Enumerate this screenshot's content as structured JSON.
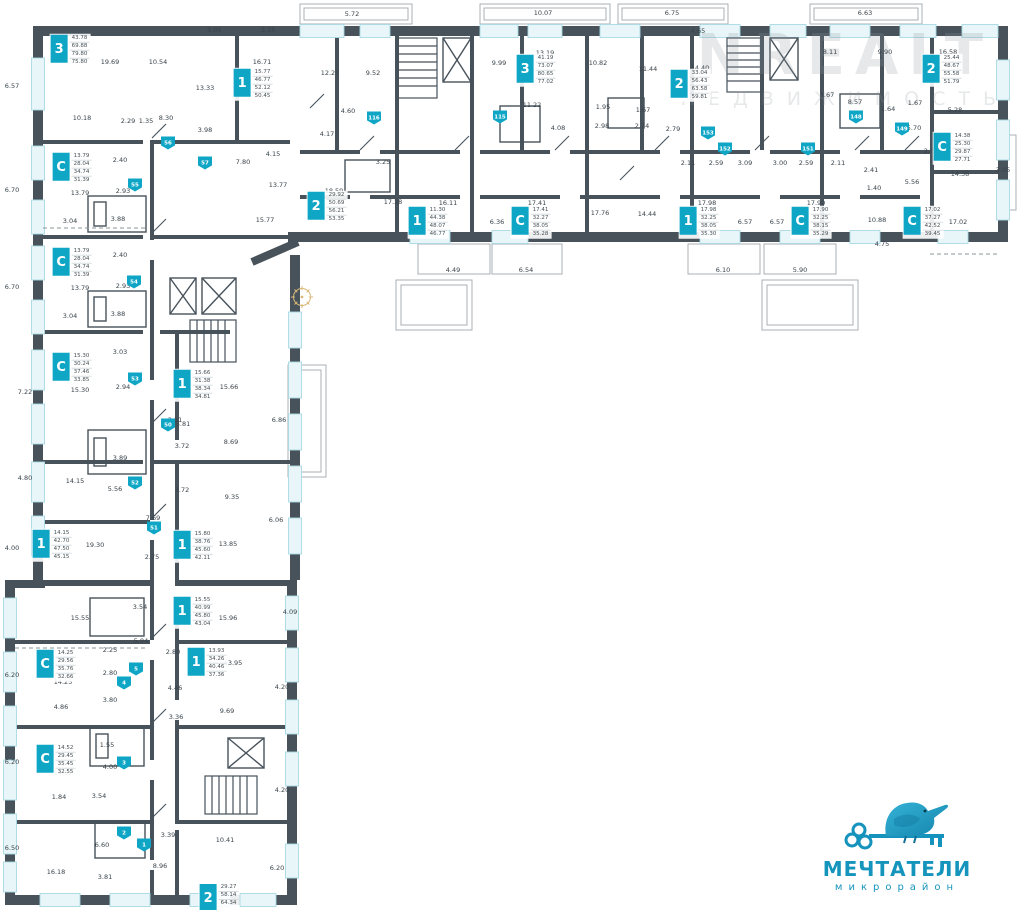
{
  "colors": {
    "accent": "#0FA6C6",
    "wall": "#47525B",
    "window": "#E8F6F9",
    "dim_text": "#39434A",
    "logo": "#1695BC"
  },
  "watermark": {
    "line1": "NREALT",
    "line2": "НЕДВИЖИМОСТЬ"
  },
  "logo": {
    "name": "МЕЧТАТЕЛИ",
    "subtitle": "микрорайон"
  },
  "plan": {
    "units": [
      {
        "type": "3",
        "x": 70,
        "y": 50,
        "areas": [
          "43.78",
          "69.88",
          "79.80",
          "75.80"
        ]
      },
      {
        "type": "1",
        "x": 253,
        "y": 84,
        "areas": [
          "15.77",
          "46.77",
          "52.12",
          "50.45"
        ]
      },
      {
        "type": "2",
        "x": 327,
        "y": 207,
        "areas": [
          "29.92",
          "50.69",
          "56.21",
          "53.35"
        ]
      },
      {
        "type": "3",
        "x": 536,
        "y": 70,
        "areas": [
          "41.19",
          "73.07",
          "80.65",
          "77.02"
        ]
      },
      {
        "type": "1",
        "x": 428,
        "y": 222,
        "areas": [
          "11.30",
          "44.38",
          "48.07",
          "46.77"
        ]
      },
      {
        "type": "C",
        "x": 531,
        "y": 222,
        "areas": [
          "17.41",
          "32.27",
          "38.05",
          "35.28"
        ]
      },
      {
        "type": "2",
        "x": 690,
        "y": 85,
        "areas": [
          "33.04",
          "56.43",
          "63.58",
          "59.81"
        ]
      },
      {
        "type": "1",
        "x": 699,
        "y": 222,
        "areas": [
          "17.98",
          "32.25",
          "38.05",
          "35.30"
        ]
      },
      {
        "type": "C",
        "x": 811,
        "y": 222,
        "areas": [
          "17.90",
          "32.25",
          "38.15",
          "35.29"
        ]
      },
      {
        "type": "2",
        "x": 942,
        "y": 70,
        "areas": [
          "25.44",
          "48.67",
          "55.58",
          "51.79"
        ]
      },
      {
        "type": "C",
        "x": 953,
        "y": 148,
        "areas": [
          "14.38",
          "25.30",
          "29.87",
          "27.71"
        ]
      },
      {
        "type": "C",
        "x": 923,
        "y": 222,
        "areas": [
          "17.02",
          "37.27",
          "42.52",
          "39.45"
        ]
      },
      {
        "type": "C",
        "x": 72,
        "y": 168,
        "areas": [
          "13.79",
          "28.04",
          "34.74",
          "31.39"
        ]
      },
      {
        "type": "C",
        "x": 72,
        "y": 263,
        "areas": [
          "13.79",
          "28.04",
          "34.74",
          "31.39"
        ]
      },
      {
        "type": "C",
        "x": 72,
        "y": 368,
        "areas": [
          "15.30",
          "30.24",
          "37.46",
          "33.85"
        ]
      },
      {
        "type": "1",
        "x": 193,
        "y": 385,
        "areas": [
          "15.66",
          "31.38",
          "38.34",
          "34.81"
        ]
      },
      {
        "type": "1",
        "x": 52,
        "y": 545,
        "areas": [
          "14.15",
          "42.70",
          "47.50",
          "45.15"
        ]
      },
      {
        "type": "1",
        "x": 193,
        "y": 546,
        "areas": [
          "15.80",
          "38.76",
          "45.60",
          "42.11"
        ]
      },
      {
        "type": "1",
        "x": 193,
        "y": 612,
        "areas": [
          "15.55",
          "40.99",
          "45.80",
          "43.04"
        ]
      },
      {
        "type": "C",
        "x": 56,
        "y": 665,
        "areas": [
          "14.25",
          "29.56",
          "35.76",
          "32.66"
        ]
      },
      {
        "type": "1",
        "x": 207,
        "y": 663,
        "areas": [
          "13.93",
          "34.26",
          "40.46",
          "37.36"
        ]
      },
      {
        "type": "C",
        "x": 56,
        "y": 760,
        "areas": [
          "14.52",
          "29.45",
          "35.45",
          "32.55"
        ]
      },
      {
        "type": "2",
        "x": 219,
        "y": 898,
        "areas": [
          "29.27",
          "58.14",
          "64.34"
        ]
      }
    ],
    "doors": [
      {
        "x": 168,
        "y": 143,
        "n": "56"
      },
      {
        "x": 205,
        "y": 163,
        "n": "57"
      },
      {
        "x": 135,
        "y": 185,
        "n": "55"
      },
      {
        "x": 134,
        "y": 282,
        "n": "54"
      },
      {
        "x": 135,
        "y": 379,
        "n": "53"
      },
      {
        "x": 135,
        "y": 483,
        "n": "52"
      },
      {
        "x": 154,
        "y": 528,
        "n": "51"
      },
      {
        "x": 168,
        "y": 425,
        "n": "50"
      },
      {
        "x": 136,
        "y": 669,
        "n": "5"
      },
      {
        "x": 124,
        "y": 683,
        "n": "4"
      },
      {
        "x": 124,
        "y": 763,
        "n": "3"
      },
      {
        "x": 124,
        "y": 833,
        "n": "2"
      },
      {
        "x": 144,
        "y": 845,
        "n": "1"
      },
      {
        "x": 500,
        "y": 117,
        "n": "115"
      },
      {
        "x": 374,
        "y": 118,
        "n": "116"
      },
      {
        "x": 856,
        "y": 117,
        "n": "148"
      },
      {
        "x": 902,
        "y": 129,
        "n": "149"
      },
      {
        "x": 808,
        "y": 149,
        "n": "151"
      },
      {
        "x": 725,
        "y": 149,
        "n": "152"
      },
      {
        "x": 708,
        "y": 133,
        "n": "153"
      }
    ],
    "dims": [
      {
        "x": 352,
        "y": 14,
        "t": "5.72"
      },
      {
        "x": 543,
        "y": 13,
        "t": "10.07"
      },
      {
        "x": 672,
        "y": 13,
        "t": "6.75"
      },
      {
        "x": 865,
        "y": 13,
        "t": "6.63"
      },
      {
        "x": 698,
        "y": 31,
        "t": "4.65"
      },
      {
        "x": 110,
        "y": 62,
        "t": "19.69"
      },
      {
        "x": 158,
        "y": 62,
        "t": "10.54"
      },
      {
        "x": 205,
        "y": 88,
        "t": "13.33"
      },
      {
        "x": 82,
        "y": 118,
        "t": "10.18"
      },
      {
        "x": 128,
        "y": 121,
        "t": "2.29"
      },
      {
        "x": 146,
        "y": 121,
        "t": "1.35"
      },
      {
        "x": 166,
        "y": 118,
        "t": "8.30"
      },
      {
        "x": 205,
        "y": 130,
        "t": "3.98"
      },
      {
        "x": 214,
        "y": 30,
        "t": "3.05"
      },
      {
        "x": 268,
        "y": 30,
        "t": "3.35"
      },
      {
        "x": 262,
        "y": 62,
        "t": "16.71"
      },
      {
        "x": 12,
        "y": 86,
        "t": "6.57"
      },
      {
        "x": 12,
        "y": 190,
        "t": "6.70"
      },
      {
        "x": 12,
        "y": 287,
        "t": "6.70"
      },
      {
        "x": 25,
        "y": 392,
        "t": "7.22"
      },
      {
        "x": 25,
        "y": 478,
        "t": "4.80"
      },
      {
        "x": 12,
        "y": 548,
        "t": "4.00"
      },
      {
        "x": 12,
        "y": 675,
        "t": "6.20"
      },
      {
        "x": 12,
        "y": 762,
        "t": "6.20"
      },
      {
        "x": 12,
        "y": 848,
        "t": "6.50"
      },
      {
        "x": 120,
        "y": 160,
        "t": "2.40"
      },
      {
        "x": 80,
        "y": 193,
        "t": "13.79"
      },
      {
        "x": 123,
        "y": 191,
        "t": "2.93"
      },
      {
        "x": 118,
        "y": 219,
        "t": "3.88"
      },
      {
        "x": 70,
        "y": 221,
        "t": "3.04"
      },
      {
        "x": 120,
        "y": 255,
        "t": "2.40"
      },
      {
        "x": 80,
        "y": 288,
        "t": "13.79"
      },
      {
        "x": 123,
        "y": 286,
        "t": "2.93"
      },
      {
        "x": 118,
        "y": 314,
        "t": "3.88"
      },
      {
        "x": 70,
        "y": 316,
        "t": "3.04"
      },
      {
        "x": 120,
        "y": 352,
        "t": "3.03"
      },
      {
        "x": 80,
        "y": 390,
        "t": "15.30"
      },
      {
        "x": 123,
        "y": 387,
        "t": "2.94"
      },
      {
        "x": 120,
        "y": 458,
        "t": "3.89"
      },
      {
        "x": 75,
        "y": 481,
        "t": "14.15"
      },
      {
        "x": 115,
        "y": 489,
        "t": "5.56"
      },
      {
        "x": 183,
        "y": 424,
        "t": "5.81"
      },
      {
        "x": 229,
        "y": 387,
        "t": "15.66"
      },
      {
        "x": 175,
        "y": 420,
        "t": "3.31"
      },
      {
        "x": 231,
        "y": 442,
        "t": "8.69"
      },
      {
        "x": 182,
        "y": 446,
        "t": "3.72"
      },
      {
        "x": 182,
        "y": 490,
        "t": "3.72"
      },
      {
        "x": 232,
        "y": 497,
        "t": "9.35"
      },
      {
        "x": 153,
        "y": 518,
        "t": "7.69"
      },
      {
        "x": 279,
        "y": 420,
        "t": "6.86"
      },
      {
        "x": 276,
        "y": 520,
        "t": "6.06"
      },
      {
        "x": 95,
        "y": 545,
        "t": "19.30"
      },
      {
        "x": 152,
        "y": 557,
        "t": "2.75"
      },
      {
        "x": 228,
        "y": 544,
        "t": "13.85"
      },
      {
        "x": 80,
        "y": 618,
        "t": "15.55"
      },
      {
        "x": 140,
        "y": 607,
        "t": "3.54"
      },
      {
        "x": 141,
        "y": 641,
        "t": "5.94"
      },
      {
        "x": 228,
        "y": 618,
        "t": "15.96"
      },
      {
        "x": 290,
        "y": 612,
        "t": "4.09"
      },
      {
        "x": 110,
        "y": 650,
        "t": "2.25"
      },
      {
        "x": 110,
        "y": 673,
        "t": "2.80"
      },
      {
        "x": 63,
        "y": 682,
        "t": "14.25"
      },
      {
        "x": 61,
        "y": 707,
        "t": "4.86"
      },
      {
        "x": 110,
        "y": 700,
        "t": "3.80"
      },
      {
        "x": 173,
        "y": 652,
        "t": "2.80"
      },
      {
        "x": 233,
        "y": 663,
        "t": "13.95"
      },
      {
        "x": 175,
        "y": 688,
        "t": "4.46"
      },
      {
        "x": 176,
        "y": 717,
        "t": "3.36"
      },
      {
        "x": 227,
        "y": 711,
        "t": "9.69"
      },
      {
        "x": 282,
        "y": 687,
        "t": "4.20"
      },
      {
        "x": 107,
        "y": 745,
        "t": "1.55"
      },
      {
        "x": 63,
        "y": 773,
        "t": "14.52"
      },
      {
        "x": 110,
        "y": 767,
        "t": "4.00"
      },
      {
        "x": 99,
        "y": 796,
        "t": "3.54"
      },
      {
        "x": 59,
        "y": 797,
        "t": "1.84"
      },
      {
        "x": 282,
        "y": 790,
        "t": "4.20"
      },
      {
        "x": 102,
        "y": 845,
        "t": "6.60"
      },
      {
        "x": 56,
        "y": 872,
        "t": "16.18"
      },
      {
        "x": 105,
        "y": 877,
        "t": "3.81"
      },
      {
        "x": 168,
        "y": 835,
        "t": "3.39"
      },
      {
        "x": 225,
        "y": 840,
        "t": "10.41"
      },
      {
        "x": 160,
        "y": 866,
        "t": "8.96"
      },
      {
        "x": 277,
        "y": 868,
        "t": "6.20"
      },
      {
        "x": 330,
        "y": 73,
        "t": "12.27"
      },
      {
        "x": 373,
        "y": 73,
        "t": "9.52"
      },
      {
        "x": 348,
        "y": 111,
        "t": "4.60"
      },
      {
        "x": 327,
        "y": 134,
        "t": "4.17"
      },
      {
        "x": 273,
        "y": 154,
        "t": "4.15"
      },
      {
        "x": 243,
        "y": 162,
        "t": "7.80"
      },
      {
        "x": 278,
        "y": 185,
        "t": "13.77"
      },
      {
        "x": 383,
        "y": 162,
        "t": "3.25"
      },
      {
        "x": 334,
        "y": 191,
        "t": "18.59"
      },
      {
        "x": 265,
        "y": 220,
        "t": "15.77"
      },
      {
        "x": 393,
        "y": 202,
        "t": "17.38"
      },
      {
        "x": 448,
        "y": 203,
        "t": "16.11"
      },
      {
        "x": 537,
        "y": 203,
        "t": "17.41"
      },
      {
        "x": 497,
        "y": 222,
        "t": "6.36"
      },
      {
        "x": 453,
        "y": 270,
        "t": "4.49"
      },
      {
        "x": 526,
        "y": 270,
        "t": "6.54"
      },
      {
        "x": 600,
        "y": 213,
        "t": "17.76"
      },
      {
        "x": 545,
        "y": 53,
        "t": "13.19"
      },
      {
        "x": 499,
        "y": 63,
        "t": "9.99"
      },
      {
        "x": 598,
        "y": 63,
        "t": "10.82"
      },
      {
        "x": 648,
        "y": 69,
        "t": "11.44"
      },
      {
        "x": 532,
        "y": 105,
        "t": "11.22"
      },
      {
        "x": 603,
        "y": 107,
        "t": "1.95"
      },
      {
        "x": 643,
        "y": 110,
        "t": "1.67"
      },
      {
        "x": 558,
        "y": 128,
        "t": "4.08"
      },
      {
        "x": 602,
        "y": 126,
        "t": "2.98"
      },
      {
        "x": 642,
        "y": 126,
        "t": "2.74"
      },
      {
        "x": 673,
        "y": 129,
        "t": "2.79"
      },
      {
        "x": 700,
        "y": 68,
        "t": "14.40"
      },
      {
        "x": 830,
        "y": 52,
        "t": "8.11"
      },
      {
        "x": 885,
        "y": 52,
        "t": "9.90"
      },
      {
        "x": 948,
        "y": 52,
        "t": "16.58"
      },
      {
        "x": 827,
        "y": 95,
        "t": "3.67"
      },
      {
        "x": 855,
        "y": 102,
        "t": "8.57"
      },
      {
        "x": 888,
        "y": 109,
        "t": "1.64"
      },
      {
        "x": 915,
        "y": 103,
        "t": "1.67"
      },
      {
        "x": 955,
        "y": 110,
        "t": "5.28"
      },
      {
        "x": 688,
        "y": 163,
        "t": "2.11"
      },
      {
        "x": 716,
        "y": 163,
        "t": "2.59"
      },
      {
        "x": 745,
        "y": 163,
        "t": "3.09"
      },
      {
        "x": 780,
        "y": 163,
        "t": "3.00"
      },
      {
        "x": 806,
        "y": 163,
        "t": "2.59"
      },
      {
        "x": 838,
        "y": 163,
        "t": "2.11"
      },
      {
        "x": 707,
        "y": 203,
        "t": "17.98"
      },
      {
        "x": 816,
        "y": 203,
        "t": "17.90"
      },
      {
        "x": 745,
        "y": 222,
        "t": "6.57"
      },
      {
        "x": 777,
        "y": 222,
        "t": "6.57"
      },
      {
        "x": 647,
        "y": 214,
        "t": "14.44"
      },
      {
        "x": 877,
        "y": 220,
        "t": "10.88"
      },
      {
        "x": 871,
        "y": 170,
        "t": "2.41"
      },
      {
        "x": 874,
        "y": 188,
        "t": "1.40"
      },
      {
        "x": 723,
        "y": 270,
        "t": "6.10"
      },
      {
        "x": 800,
        "y": 270,
        "t": "5.90"
      },
      {
        "x": 882,
        "y": 244,
        "t": "4.75"
      },
      {
        "x": 914,
        "y": 128,
        "t": "5.70"
      },
      {
        "x": 931,
        "y": 151,
        "t": "2.09"
      },
      {
        "x": 960,
        "y": 174,
        "t": "14.38"
      },
      {
        "x": 1003,
        "y": 170,
        "t": "3.95"
      },
      {
        "x": 912,
        "y": 182,
        "t": "5.56"
      },
      {
        "x": 958,
        "y": 222,
        "t": "17.02"
      }
    ]
  }
}
